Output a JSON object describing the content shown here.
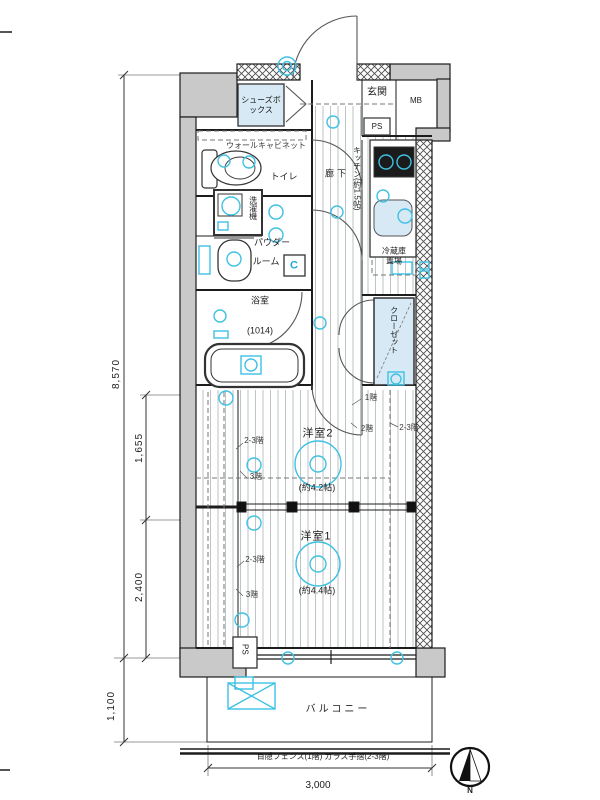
{
  "rooms": {
    "genkan": "玄関",
    "shoes_box": "シューズボックス",
    "mb": "MB",
    "ps": "PS",
    "toilet": "トイレ",
    "wall_cabinet": "ウォールキャビネット",
    "hallway": "廊下",
    "kitchen": "キッチン(約1.5帖)",
    "laundry": "洗濯機",
    "powder_line1": "パウダー",
    "powder_line2": "ルーム",
    "c_mark": "C",
    "bath": "浴室",
    "bath_size": "(1014)",
    "fridge": "冷蔵庫置場",
    "closet": "クローゼット",
    "room2": "洋室2",
    "room2_size": "(約4.2帖)",
    "room1": "洋室1",
    "room1_size": "(約4.4帖)",
    "balcony": "バルコニー",
    "ps_lower": "PS"
  },
  "notes": {
    "fence": "目隠フェンス(1階) ガラス手摺(2-3階)",
    "f1": "1階",
    "f2": "2階",
    "f23_right": "2-3階",
    "f23_upper": "2-3階",
    "f3_upper": "3階",
    "f23_lower": "2-3階",
    "f3_lower": "3階",
    "compass_n": "N"
  },
  "dimensions": {
    "total_depth": "8,570",
    "room2_depth": "1,655",
    "room1_depth": "2,400",
    "balcony_depth": "1,100",
    "width": "3,000"
  },
  "colors": {
    "symbol_cyan": "#3fc1e3",
    "wall_gray": "#c9c9c9",
    "fixture_fill": "#d6e9f5",
    "line": "#1c1c1c"
  }
}
